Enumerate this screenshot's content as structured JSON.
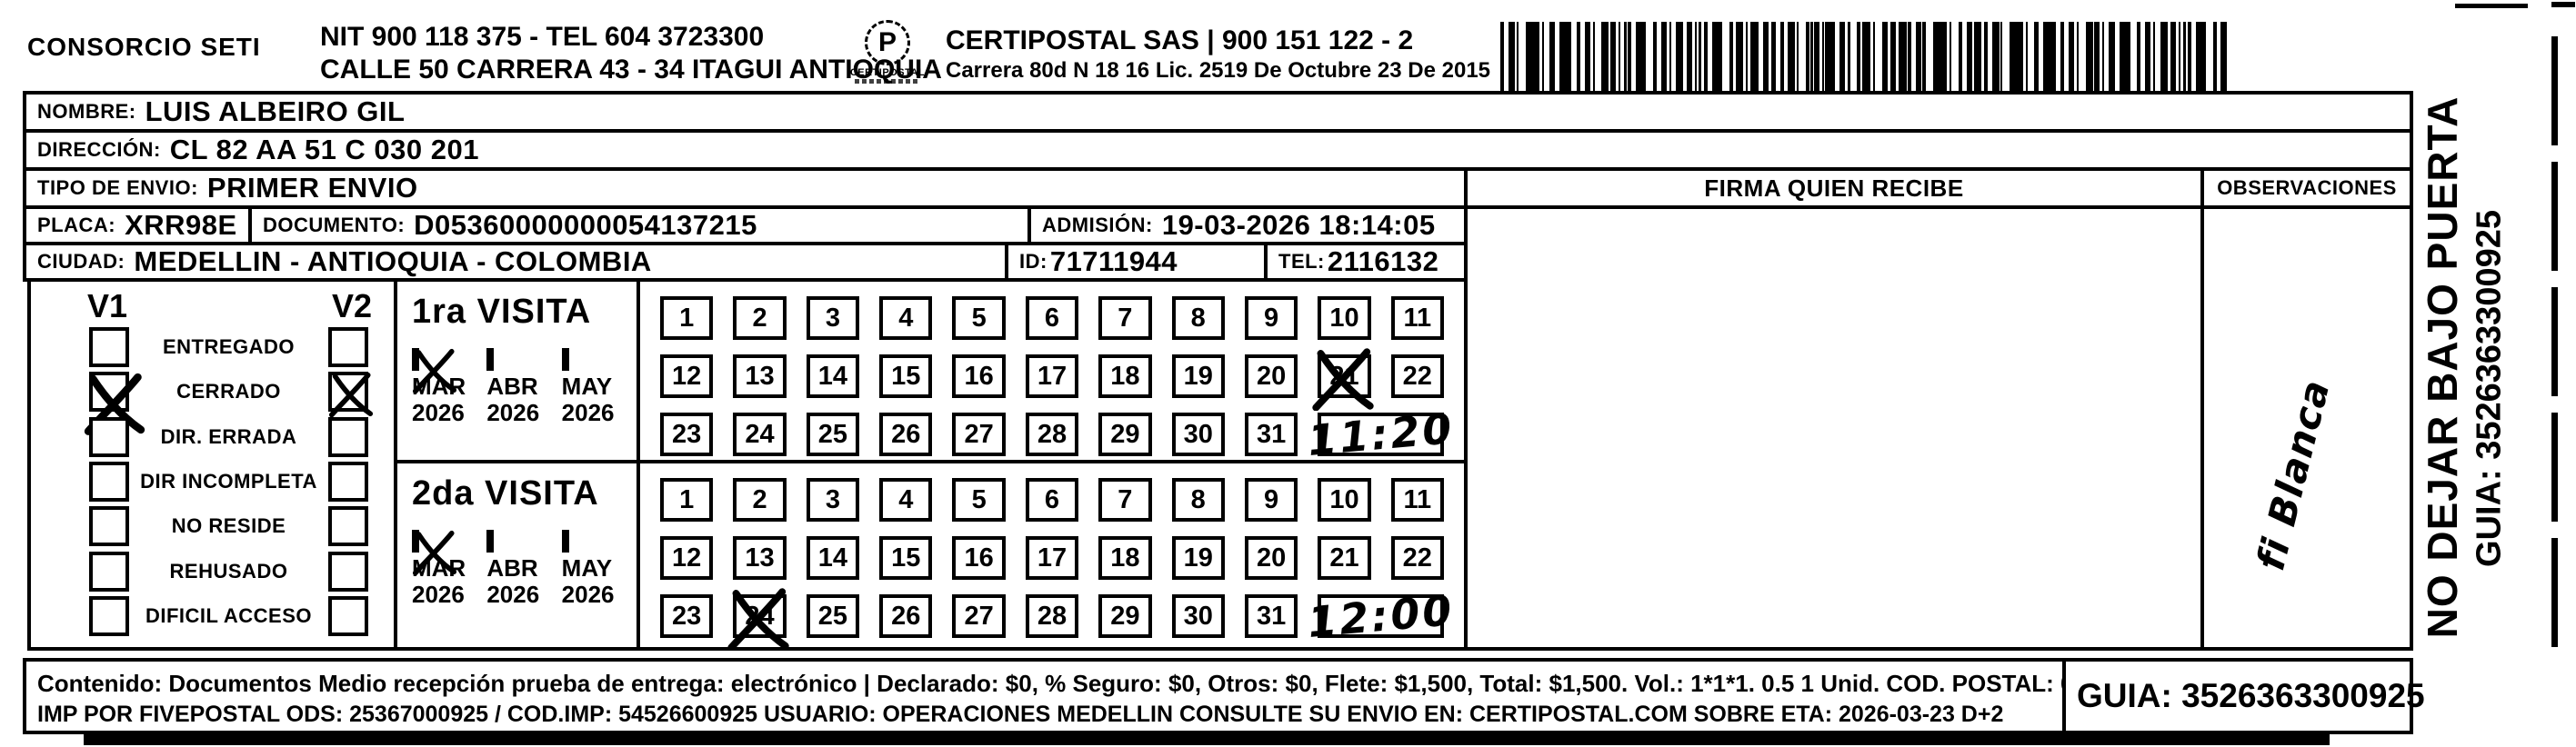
{
  "header": {
    "company": "CONSORCIO SETI",
    "nit_line": "NIT 900 118 375 - TEL 604 3723300",
    "address_line": "CALLE 50 CARRERA 43 - 34 ITAGUI ANTIOQUIA",
    "certipostal_line": "CERTIPOSTAL SAS | 900 151 122 - 2",
    "license_line": "Carrera 80d N 18 16  Lic. 2519 De Octubre 23 De 2015",
    "logo_text": "CERTIPOSTAL",
    "logo_glyph": "P"
  },
  "recipient": {
    "nombre_label": "NOMBRE:",
    "nombre": "LUIS ALBEIRO GIL",
    "direccion_label": "DIRECCIÓN:",
    "direccion": "CL 82 AA 51 C 030 201",
    "tipo_envio_label": "TIPO DE ENVIO:",
    "tipo_envio": "PRIMER ENVIO",
    "placa_label": "PLACA:",
    "placa": "XRR98E",
    "documento_label": "DOCUMENTO:",
    "documento": "D05360000000054137215",
    "admision_label": "ADMISIÓN:",
    "admision": "19-03-2026 18:14:05",
    "ciudad_label": "CIUDAD:",
    "ciudad": "MEDELLIN - ANTIOQUIA - COLOMBIA",
    "id_label": "ID:",
    "id": "71711944",
    "tel_label": "TEL:",
    "tel": "2116132"
  },
  "firma": {
    "header": "FIRMA QUIEN RECIBE",
    "signature": "fi Blanca"
  },
  "observaciones": {
    "header": "OBSERVACIONES"
  },
  "status_panel": {
    "v1_label": "V1",
    "v2_label": "V2",
    "items": [
      {
        "label": "ENTREGADO",
        "v1": false,
        "v2": false
      },
      {
        "label": "CERRADO",
        "v1": true,
        "v2": true
      },
      {
        "label": "DIR. ERRADA",
        "v1": false,
        "v2": false
      },
      {
        "label": "DIR INCOMPLETA",
        "v1": false,
        "v2": false
      },
      {
        "label": "NO RESIDE",
        "v1": false,
        "v2": false
      },
      {
        "label": "REHUSADO",
        "v1": false,
        "v2": false
      },
      {
        "label": "DIFICIL ACCESO",
        "v1": false,
        "v2": false
      }
    ]
  },
  "visits": [
    {
      "title": "1ra VISITA",
      "months": [
        {
          "label": "MAR",
          "year": "2026",
          "checked": true
        },
        {
          "label": "ABR",
          "year": "2026",
          "checked": false
        },
        {
          "label": "MAY",
          "year": "2026",
          "checked": false
        }
      ],
      "day_rows": [
        [
          1,
          2,
          3,
          4,
          5,
          6,
          7,
          8,
          9,
          10,
          11
        ],
        [
          12,
          13,
          14,
          15,
          16,
          17,
          18,
          19,
          20,
          21,
          22
        ],
        [
          23,
          24,
          25,
          26,
          27,
          28,
          29,
          30,
          31
        ]
      ],
      "crossed_day": 21,
      "handwritten_time": "11:20"
    },
    {
      "title": "2da VISITA",
      "months": [
        {
          "label": "MAR",
          "year": "2026",
          "checked": true
        },
        {
          "label": "ABR",
          "year": "2026",
          "checked": false
        },
        {
          "label": "MAY",
          "year": "2026",
          "checked": false
        }
      ],
      "day_rows": [
        [
          1,
          2,
          3,
          4,
          5,
          6,
          7,
          8,
          9,
          10,
          11
        ],
        [
          12,
          13,
          14,
          15,
          16,
          17,
          18,
          19,
          20,
          21,
          22
        ],
        [
          23,
          24,
          25,
          26,
          27,
          28,
          29,
          30,
          31
        ]
      ],
      "crossed_day": 24,
      "handwritten_time": "12:00"
    }
  ],
  "side_note": {
    "line1": "NO DEJAR BAJO PUERTA",
    "line2": "GUIA: 3526363300925"
  },
  "footer": {
    "contenido_line": "Contenido: Documentos Medio recepción prueba de entrega: electrónico | Declarado: $0, % Seguro: $0, Otros: $0, Flete: $1,500, Total: $1,500. Vol.: 1*1*1. 0.5  1 Unid. COD. POSTAL: 050006",
    "imp_line": "IMP POR FIVEPOSTAL ODS: 25367000925 / COD.IMP: 54526600925 USUARIO: OPERACIONES MEDELLIN CONSULTE SU ENVIO EN: CERTIPOSTAL.COM SOBRE ETA: 2026-03-23 D+2",
    "guia": "GUIA: 3526363300925"
  }
}
